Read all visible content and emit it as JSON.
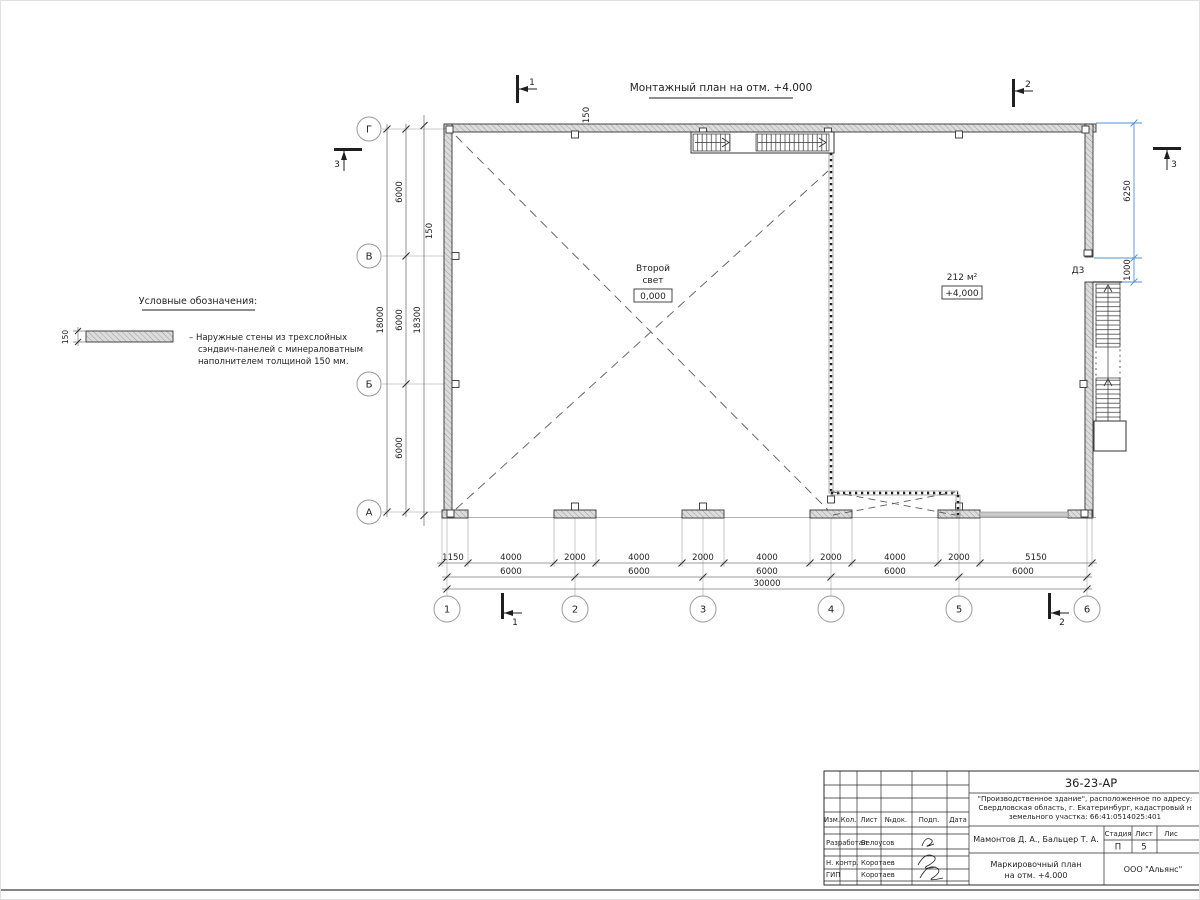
{
  "drawing": {
    "title": "Монтажный план на отм. +4.000",
    "room_left_line1": "Второй",
    "room_left_line2": "свет",
    "room_left_level": "0,000",
    "room_right_area": "212 м²",
    "room_right_level": "+4,000",
    "door_label": "Д3",
    "wall_thickness_top": "150",
    "wall_thickness_left": "150"
  },
  "legend": {
    "title": "Условные обозначения:",
    "thickness": "150",
    "line1": "– Наружные стены из трехслойных",
    "line2": "сэндвич-панелей с минераловатным",
    "line3": "наполнителем толщиной 150 мм."
  },
  "axes": {
    "cols": [
      "1",
      "2",
      "3",
      "4",
      "5",
      "6"
    ],
    "rows": [
      "Г",
      "В",
      "Б",
      "А"
    ]
  },
  "sections": {
    "one": "1",
    "two": "2",
    "three": "3"
  },
  "dims": {
    "b1": [
      "1150",
      "4000",
      "2000",
      "4000",
      "2000",
      "4000",
      "2000",
      "4000",
      "2000",
      "5150"
    ],
    "b2": [
      "6000",
      "6000",
      "6000",
      "6000",
      "6000"
    ],
    "b3": "30000",
    "l1": [
      "6000",
      "6000",
      "6000"
    ],
    "l_total": "18000",
    "l_overall": "18300",
    "r1": "6250",
    "r2": "1000"
  },
  "titleblock": {
    "doc_number": "36-23-АР",
    "address1": "\"Производственное здание\", расположенное по адресу:",
    "address2": "Свердловская область, г. Екатеринбург, кадастровый н",
    "address3": "земельного участка: 66:41:0514025:401",
    "header_cols": [
      "Изм.",
      "Кол.",
      "Лист",
      "№док.",
      "Подп.",
      "Дата"
    ],
    "stage_header": [
      "Стадия",
      "Лист",
      "Лис"
    ],
    "stage_value": "П",
    "sheet_value": "5",
    "authors": "Мамонтов Д. А., Бальцер Т. А.",
    "role1": "Разработал",
    "name1": "Белоусов",
    "role2": "Н. контр.",
    "name2": "Коротаев",
    "role3": "ГИП",
    "name3": "Коротаев",
    "drawing_title1": "Маркировочный план",
    "drawing_title2": "на отм. +4.000",
    "company": "ООО \"Альянс\""
  },
  "colors": {
    "line": "#2b2b2b",
    "dim_blue": "#4f93d2",
    "light": "#b5b5b5"
  }
}
